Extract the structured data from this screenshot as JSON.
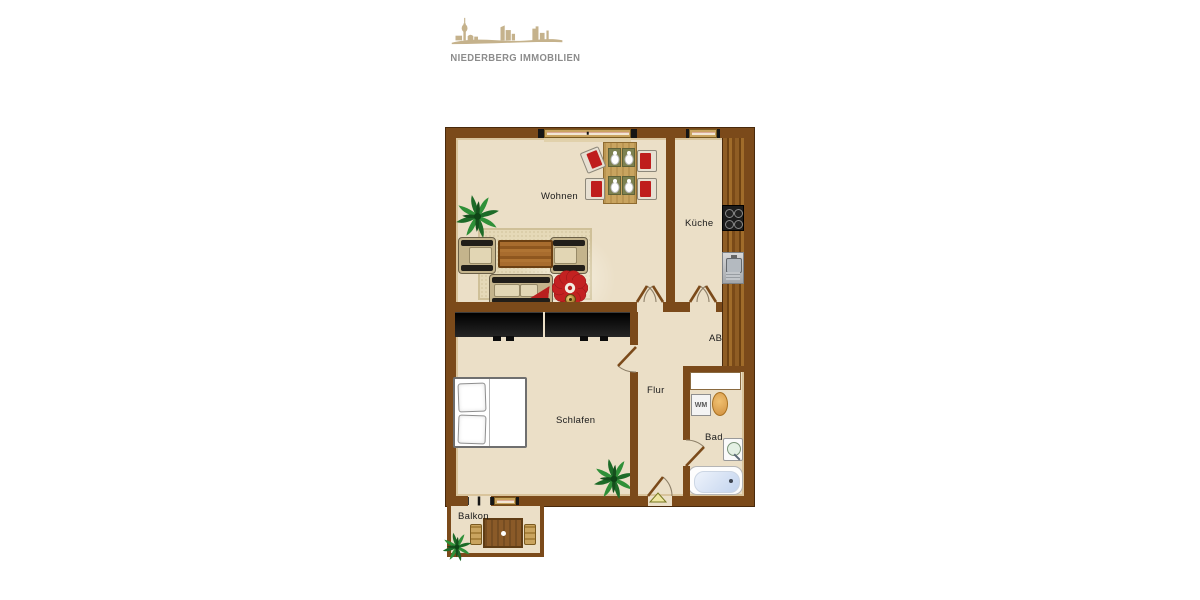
{
  "logo": {
    "company": "NIEDERBERG IMMOBILIEN",
    "icon": "duesseldorf-skyline-icon",
    "icon_color": "#c5b28c",
    "text_color": "#8c8c8c"
  },
  "floorplan": {
    "rooms": {
      "wohnen": "Wohnen",
      "kueche": "Küche",
      "ab": "AB",
      "flur": "Flur",
      "schlafen": "Schlafen",
      "bad": "Bad",
      "balkon": "Balkon"
    },
    "appliances": {
      "washing_machine": "WM"
    },
    "colors": {
      "wall": "#7b4a1a",
      "wall_outline": "#48290c",
      "floor": "#ebdfc7",
      "wood_builtin": "#8f5d24",
      "furniture_black": "#141414",
      "accent_red": "#c32121",
      "window_frame": "#c9a45f"
    }
  }
}
